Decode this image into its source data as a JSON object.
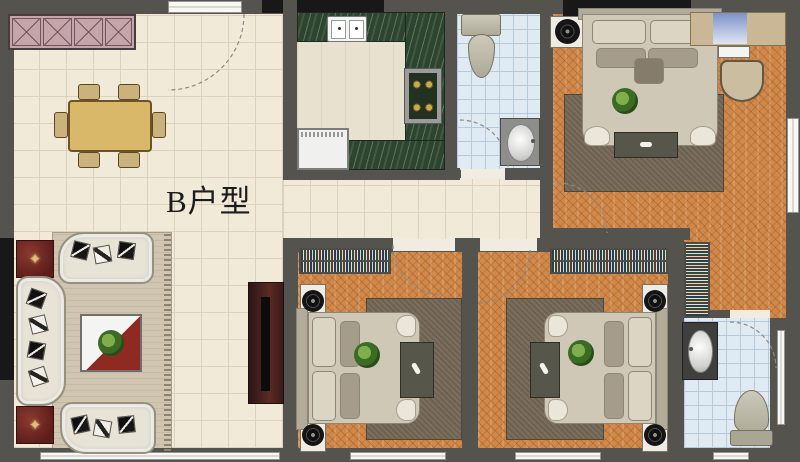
{
  "label": {
    "text": "B户型"
  },
  "icons": {
    "ornament": "✦"
  },
  "theme": {
    "wall": "#55534d",
    "wall-dark": "#181818",
    "floor-cream": "#f2ead8",
    "floor-cream-line": "#dbd1bc",
    "parquet": "#d0894a",
    "tile-blue": "#e0eaf2",
    "tile-blue-line": "#b7c9db",
    "counter-green": "#2d4431",
    "rug-brown": "#7b6e5d",
    "rug-beige": "#cfc5b0",
    "sofa": "#e7e3d7",
    "bed": "#cfc8b6",
    "accent-red": "#6e2420",
    "table-tan": "#d9b86a",
    "cabinet-pink": "#c5a4aa",
    "window": "#f8f8f5"
  },
  "rooms": [
    {
      "id": "dining-entry",
      "furniture": [
        "pink-sideboard",
        "dining-table",
        "six-chairs",
        "entry-door"
      ]
    },
    {
      "id": "kitchen",
      "furniture": [
        "u-shaped-counter",
        "double-sink",
        "gas-stove",
        "appliance"
      ]
    },
    {
      "id": "bathroom-top",
      "furniture": [
        "toilet",
        "washbasin",
        "door-swing"
      ]
    },
    {
      "id": "master-bedroom",
      "furniture": [
        "wardrobe",
        "double-bed",
        "speaker-nightstand",
        "area-rug",
        "foot-bench",
        "dresser-with-mirror",
        "stool",
        "door-swing",
        "window"
      ]
    },
    {
      "id": "living-room",
      "furniture": [
        "u-sofa-set",
        "throw-pillows",
        "coffee-table-with-plant",
        "red-side-tables",
        "tv-cabinet",
        "area-rug"
      ]
    },
    {
      "id": "bedroom-2",
      "furniture": [
        "bookshelf",
        "double-bed",
        "speaker-nightstands",
        "area-rug",
        "side-desk",
        "door-swing"
      ]
    },
    {
      "id": "bedroom-3",
      "furniture": [
        "bookshelf",
        "double-bed",
        "speaker-nightstands",
        "area-rug",
        "side-desk",
        "door-swing",
        "closet"
      ]
    },
    {
      "id": "bathroom-bottom",
      "furniture": [
        "washbasin",
        "toilet",
        "door-swing",
        "window"
      ]
    }
  ]
}
